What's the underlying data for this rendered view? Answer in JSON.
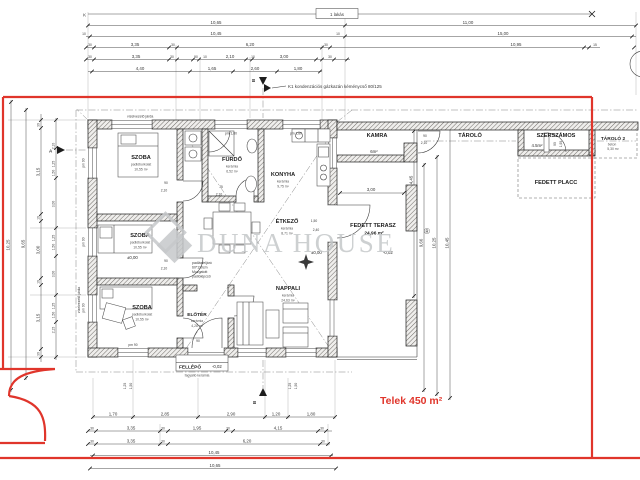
{
  "colors": {
    "red": "#e0352b",
    "ink": "#3a3a3a",
    "watermark_gray": "#c5c8ca"
  },
  "header": {
    "k_mark": "K",
    "unit_label": "1 lakás",
    "chimney_note": "K1 kondenzációs gázkazán kéménycső 80/125"
  },
  "site": {
    "plot_label": "Telek 450 m²"
  },
  "watermark": {
    "text": "DUNA HOUSE",
    "reg": "®"
  },
  "sections": {
    "a": "A",
    "b_top": "B",
    "b_bottom": "B"
  },
  "notes": {
    "walkway_top": "vízelvezető járda",
    "walkway_left": "vízelvezető járda",
    "attic1": "padlásfeljáró",
    "attic2": "60*110cm",
    "attic3": "Mozgatott",
    "attic4": "padlólépcső"
  },
  "levels": {
    "zero_room": "±0,00",
    "zero_main": "±0,00",
    "terrace": "-0,02",
    "step": "-0,02"
  },
  "rooms": {
    "szoba1": {
      "name": "SZOBA",
      "material": "padlóburkolat",
      "area": "10,55 m²"
    },
    "szoba2": {
      "name": "SZOBA",
      "material": "padlóburkolat",
      "area": "10,55 m²"
    },
    "szoba3": {
      "name": "SZOBA",
      "material": "padlóburkolat",
      "area": "10,55 m²"
    },
    "furdo": {
      "name": "FÜRDŐ",
      "material": "kerámia",
      "area": "6,52 m²"
    },
    "konyha": {
      "name": "KONYHA",
      "material": "kerámia",
      "area": "9,75 m²"
    },
    "etkezo": {
      "name": "ÉTKEZŐ",
      "material": "kerámia",
      "area": "8,71 m²"
    },
    "nappali": {
      "name": "NAPPALI",
      "material": "kerámia",
      "area": "24,63 m²"
    },
    "eloter": {
      "name": "ELŐTÉR",
      "material": "kerámia",
      "area": "4,28 m²"
    },
    "fellepo": {
      "name": "FELLÉPŐ",
      "material": "fagyálló kerámia"
    },
    "kamra": {
      "name": "KAMRA",
      "area": "6m²"
    },
    "terasz": {
      "name": "FEDETT TERASZ",
      "area": "24,96 m²"
    },
    "tarolo": {
      "name": "TÁROLÓ"
    },
    "szerszamos": {
      "name": "SZERSZÁMOS",
      "area": "4.5m²"
    },
    "tarolo2": {
      "name": "TÁROLÓ 2",
      "material": "beton",
      "area": "5,30 m²"
    },
    "placc": {
      "name": "FEDETT PLACC"
    }
  },
  "dims": {
    "t2": [
      "10,65",
      "11,00"
    ],
    "t3": [
      "10",
      "10,45",
      "10",
      "15,00"
    ],
    "t4": [
      "30",
      "3,35",
      "30",
      "6,20",
      "30",
      "10,95",
      "15"
    ],
    "t5": [
      "30",
      "3,35",
      "30",
      "90",
      "10",
      "2,10",
      "10",
      "3,00",
      "30"
    ],
    "t6": [
      "4,40",
      "1,65",
      "2,60",
      "1,80"
    ],
    "b1": [
      "1,70",
      "2,85",
      "2,90",
      "1,20",
      "1,80"
    ],
    "b2": [
      "30",
      "3,35",
      "30",
      "1,95",
      "30",
      "4,15",
      "30"
    ],
    "b3": [
      "30",
      "3,35",
      "30",
      "6,20",
      "30"
    ],
    "b4": [
      "10,45"
    ],
    "b5": [
      "10,65"
    ],
    "l1": [
      "10,25"
    ],
    "l2": [
      "9,65"
    ],
    "l3": [
      "30",
      "3,15",
      "10",
      "3,00",
      "10",
      "3,15",
      "30"
    ],
    "l4": [
      "2,10",
      "1,25",
      "1,50",
      "3,00",
      "1,25",
      "1,50",
      "3,00",
      "1,25",
      "1,50",
      "2,15"
    ],
    "r": [
      "4,45",
      "9,66",
      "10,25",
      "10,45"
    ],
    "terrace_w": "3,00"
  },
  "openings": {
    "szoba1_door": [
      "90",
      "2,10"
    ],
    "szoba2_door": [
      "90",
      "2,10"
    ],
    "furdo_door": [
      "75",
      "2,10"
    ],
    "kamra_door": [
      "90",
      "2,10"
    ],
    "terasz_door": [
      "1,50",
      "2,40"
    ],
    "eloter_door": "90",
    "szerszamos_door": [
      "90",
      "1,95"
    ],
    "pm_180_a": "pm 1,80",
    "pm_180_b": "pm 1,80",
    "pm_90_a": "pm 90",
    "pm_90_b": "pm 90",
    "pm_90_c": "pm 90",
    "pm_90_d": "pm 90",
    "b_win1": [
      "1,25",
      "1,50"
    ],
    "b_win2": [
      "1,25",
      "1,50"
    ]
  }
}
